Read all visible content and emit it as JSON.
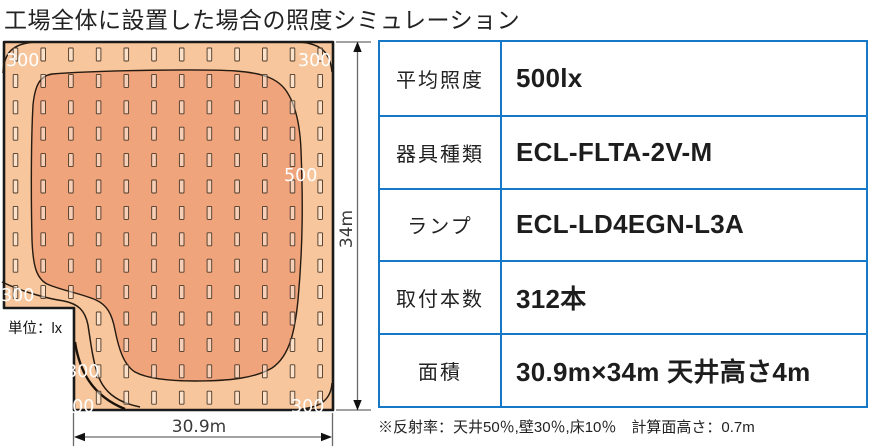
{
  "title": "工場全体に設置した場合の照度シミュレーション",
  "diagram": {
    "unit_label": "単位：lx",
    "width_dimension": "30.9m",
    "height_dimension": "34m",
    "contour_labels": [
      "300",
      "300",
      "500",
      "300",
      "300",
      "200",
      "300"
    ],
    "contour_values_lx": [
      300,
      300,
      500,
      300,
      300,
      200,
      300
    ],
    "colors": {
      "zone_300_to_500": "#f8c69c",
      "zone_over_500": "#efa47c",
      "outline": "#1a1a1a",
      "contour_line": "#241a10"
    },
    "lamp_grid": {
      "cols": 12,
      "rows": 14,
      "x0": 13.2,
      "y0": 48,
      "dx": 27.7,
      "dy": 26.4,
      "lamp_w": 4.6,
      "lamp_h": 13,
      "notch_max_x": 75,
      "notch_min_y": 305
    }
  },
  "table": {
    "border_color": "#1878c8",
    "rows": [
      {
        "label": "平均照度",
        "value": "500lx"
      },
      {
        "label": "器具種類",
        "value": "ECL-FLTA-2V-M"
      },
      {
        "label": "ランプ",
        "value": "ECL-LD4EGN-L3A"
      },
      {
        "label": "取付本数",
        "value": "312本"
      },
      {
        "label": "面積",
        "value": "30.9m×34m 天井高さ4m"
      }
    ]
  },
  "footnote": "※反射率：天井50％,壁30％,床10％　計算面高さ：0.7m"
}
